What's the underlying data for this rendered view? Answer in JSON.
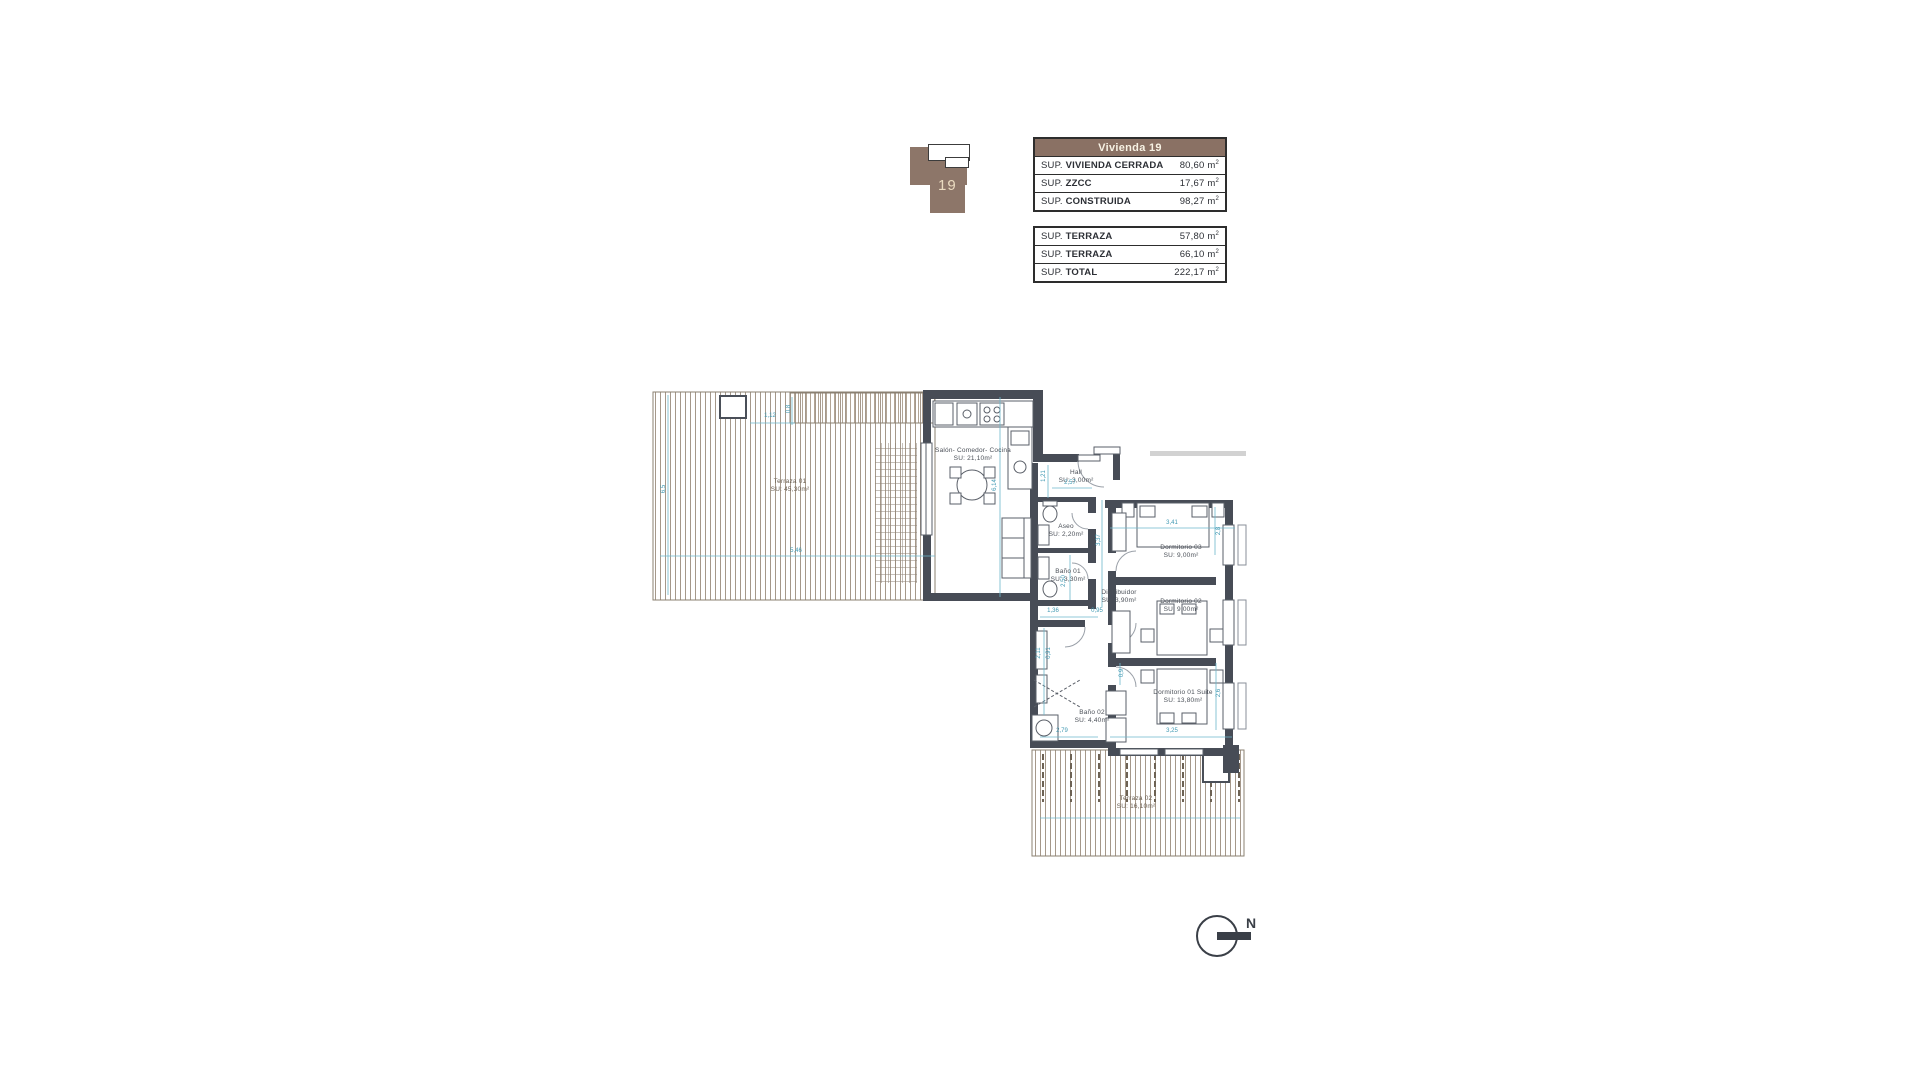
{
  "colors": {
    "wall": "#474c56",
    "table_header_bg": "#8a7164",
    "dimension_blue": "#3f98b2",
    "terrace_hatch": "#a5988a",
    "keyplan_brown": "#8d7669"
  },
  "key_plan": {
    "unit_label": "19"
  },
  "summary_table": {
    "title": "Vivienda 19",
    "rows": [
      {
        "prefix": "SUP. ",
        "label": "VIVIENDA CERRADA",
        "value": "80,60",
        "unit": "m",
        "exp": "2"
      },
      {
        "prefix": "SUP. ",
        "label": "ZZCC",
        "value": "17,67",
        "unit": "m",
        "exp": "2"
      },
      {
        "prefix": "SUP. ",
        "label": "CONSTRUIDA",
        "value": "98,27",
        "unit": "m",
        "exp": "2"
      }
    ]
  },
  "terrace_table": {
    "rows": [
      {
        "prefix": "SUP. ",
        "label": "TERRAZA",
        "value": "57,80",
        "unit": "m",
        "exp": "2"
      },
      {
        "prefix": "SUP. ",
        "label": "TERRAZA",
        "value": "66,10",
        "unit": "m",
        "exp": "2"
      },
      {
        "prefix": "SUP. ",
        "label": "TOTAL",
        "value": "222,17",
        "unit": "m",
        "exp": "2"
      }
    ]
  },
  "plan": {
    "rooms": [
      {
        "name": "Salón- Comedor- Cocina",
        "area": "SU: 21,10m²"
      },
      {
        "name": "Hall",
        "area": "SU: 3,00m²"
      },
      {
        "name": "Aseo",
        "area": "SU: 2,20m²"
      },
      {
        "name": "Baño 01",
        "area": "SU: 3,30m²"
      },
      {
        "name": "Distribuidor",
        "area": "SU: 3,90m²"
      },
      {
        "name": "Dormitorio 03",
        "area": "SU: 9,00m²"
      },
      {
        "name": "Dormitorio 02",
        "area": "SU: 9,00m²"
      },
      {
        "name": "Dormitorio 01 Suite",
        "area": "SU: 13,80m²"
      },
      {
        "name": "Baño 02",
        "area": "SU: 4,40m²"
      },
      {
        "name": "Terraza 01",
        "area": "SU: 45,30m²"
      },
      {
        "name": "Terraza 02",
        "area": "SU: 16,10m²"
      }
    ],
    "dimensions": [
      "6,14",
      "1,21",
      "2,57",
      "3,41",
      "2,8",
      "2,50",
      "3,37",
      "1,36",
      "0,95",
      "2,11",
      "0,91",
      "0,9",
      "2,79",
      "3,25",
      "2,6",
      "5,46",
      "6,5",
      "1,12",
      "0,8"
    ],
    "compass": "N"
  }
}
